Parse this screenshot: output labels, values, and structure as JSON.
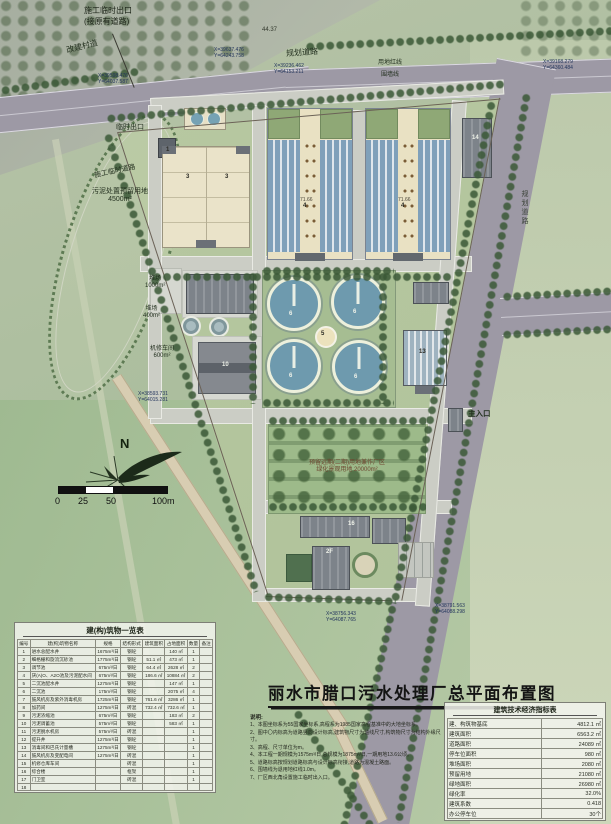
{
  "title": {
    "main": "丽水市腊口污水处理厂总平面布置图"
  },
  "compass": {
    "north": "N"
  },
  "scale_bar": {
    "labels": [
      "0",
      "25",
      "50",
      "100m"
    ]
  },
  "palette": {
    "road": "#9d99a5",
    "field_green": "#aec29c",
    "site_green": "#b6c6a0",
    "tank_blue": "#6e9aae",
    "building_beige": "#eae3c9",
    "roof_gray": "#7d838a",
    "tan_road": "#d8cdb2",
    "tree_green": "#4f7048",
    "title_color": "#141414"
  },
  "labels": {
    "top_exit": "施工临时出口",
    "top_exit_sub": "(接原有道路)",
    "village_road": "改建村道",
    "planned_road_top": "规划道路",
    "planned_road_right": "规划道路",
    "red_line": "用地红线",
    "wall_line": "围墙线",
    "dim_top": "44.37",
    "temp_exit": "临时出口",
    "temp_road": "施工临时道路",
    "sludge_reserve": "污泥处置预留用地",
    "sludge_reserve_area": "4500m²",
    "yard1": "堆场",
    "yard1_area": "1000m²",
    "yard2": "堆场",
    "yard2_area": "400m²",
    "workshop": "机修车间",
    "workshop_area": "600m²",
    "main_entrance": "主入口",
    "reserve_line1": "预留远期(二期)用地兼作厂区",
    "reserve_line2": "绿化景观用地 20000m²",
    "elev1": "71.66",
    "elev2": "71.66"
  },
  "coords": [
    {
      "x": "X=39598.476",
      "y": "Y=64037.587"
    },
    {
      "x": "X=39637.476",
      "y": "Y=64243.758"
    },
    {
      "x": "X=39168.279",
      "y": "Y=64360.484"
    },
    {
      "x": "X=39236.462",
      "y": "Y=64153.211"
    },
    {
      "x": "X=38593.731",
      "y": "Y=64015.281"
    },
    {
      "x": "X=38756.343",
      "y": "Y=64087.765"
    },
    {
      "x": "X=38791.563",
      "y": "Y=64088.298"
    }
  ],
  "building_numbers": [
    "1",
    "3",
    "3",
    "4",
    "4",
    "5",
    "6",
    "6",
    "6",
    "6",
    "10",
    "13",
    "14",
    "16",
    "2F"
  ],
  "tables": {
    "buildings": {
      "title": "建(构)筑物一览表",
      "headers": [
        "编号",
        "建(构)筑物名称",
        "规格",
        "结构形式",
        "建筑面积",
        "占地面积",
        "数量",
        "备注"
      ],
      "rows": [
        [
          "1",
          "进水总配水井",
          "1675m³/日",
          "钢砼",
          "",
          "140 ㎡",
          "1",
          ""
        ],
        [
          "2",
          "细格栅和旋流沉砂池",
          "1775m³/日",
          "钢砼",
          "51.1 ㎡",
          "473 ㎡",
          "1",
          ""
        ],
        [
          "3",
          "调节池",
          "675m³/日",
          "钢砼",
          "64.4 ㎡",
          "2628 ㎡",
          "2",
          ""
        ],
        [
          "4",
          "厌(A)O、A2O池及污泥配水间",
          "675m³/日",
          "钢砼",
          "186.6 ㎡",
          "10884 ㎡",
          "2",
          ""
        ],
        [
          "5",
          "二沉池配水井",
          "1275m³/日",
          "钢砼",
          "",
          "147 ㎡",
          "1",
          ""
        ],
        [
          "6",
          "二沉池",
          "175m³/日",
          "钢砼",
          "",
          "2075 ㎡",
          "4",
          ""
        ],
        [
          "7",
          "鼓风机房及紫外消毒机房",
          "1725m³/日",
          "钢砼",
          "761.6 ㎡",
          "3286 ㎡",
          "1",
          ""
        ],
        [
          "8",
          "加药间",
          "1275m³/日",
          "砖混",
          "732.4 ㎡",
          "732.6 ㎡",
          "1",
          ""
        ],
        [
          "9",
          "污泥浓缩池",
          "675m³/日",
          "钢砼",
          "",
          "183 ㎡",
          "2",
          ""
        ],
        [
          "10",
          "污泥调蓄池",
          "575m³/日",
          "钢砼",
          "",
          "583 ㎡",
          "1",
          ""
        ],
        [
          "11",
          "污泥脱水机房",
          "575m³/日",
          "砖混",
          "",
          "",
          "1",
          ""
        ],
        [
          "12",
          "提升井",
          "1275m³/日",
          "钢砼",
          "",
          "",
          "1",
          ""
        ],
        [
          "13",
          "消毒间和巴氏计量槽",
          "1275m³/日",
          "钢砼",
          "",
          "",
          "1",
          ""
        ],
        [
          "14",
          "鼓风机房及变配电间",
          "1275m³/日",
          "砖混",
          "",
          "",
          "1",
          ""
        ],
        [
          "15",
          "机修仓库车间",
          "",
          "砖混",
          "",
          "",
          "1",
          ""
        ],
        [
          "16",
          "综合楼",
          "",
          "框架",
          "",
          "",
          "1",
          ""
        ],
        [
          "17",
          "门卫室",
          "",
          "砖混",
          "",
          "",
          "1",
          ""
        ],
        [
          "18",
          "",
          "",
          "",
          "",
          "",
          "",
          ""
        ]
      ]
    },
    "indicators": {
      "title": "建筑技术经济指标表",
      "rows": [
        [
          "建、构筑物基底",
          "4812.1 ㎡"
        ],
        [
          "建筑面积",
          "6563.2 ㎡"
        ],
        [
          "道路面积",
          "24089 ㎡"
        ],
        [
          "停车位面积",
          "980 ㎡"
        ],
        [
          "堆场面积",
          "2080 ㎡"
        ],
        [
          "预留用地",
          "21080 ㎡"
        ],
        [
          "绿地面积",
          "26980 ㎡"
        ],
        [
          "绿化率",
          "32.0%"
        ],
        [
          "建筑系数",
          "0.418"
        ],
        [
          "办公停车位",
          "30个"
        ]
      ]
    }
  },
  "notes": {
    "heading": "说明:",
    "items": [
      "1、本图坐标系为55国家坐标系,高程系为1985国家高程基准中的大地坐标系。",
      "2、图中〇内标高为道路竖向设计标高,建筑物尺寸为轴线尺寸,构筑物尺寸为结构外缘尺寸。",
      "3、高程、尺寸单位为m。",
      "4、本工程一期规模为1575m³/日,总规模为1875m³/日,一期用地13.6公顷。",
      "5、道路标高按规划道路标高与设计标高衔接,道路为混凝土路面。",
      "6、围墙线为退用地红线1.0m。",
      "7、厂区西北角设置施工临时出入口。"
    ]
  }
}
